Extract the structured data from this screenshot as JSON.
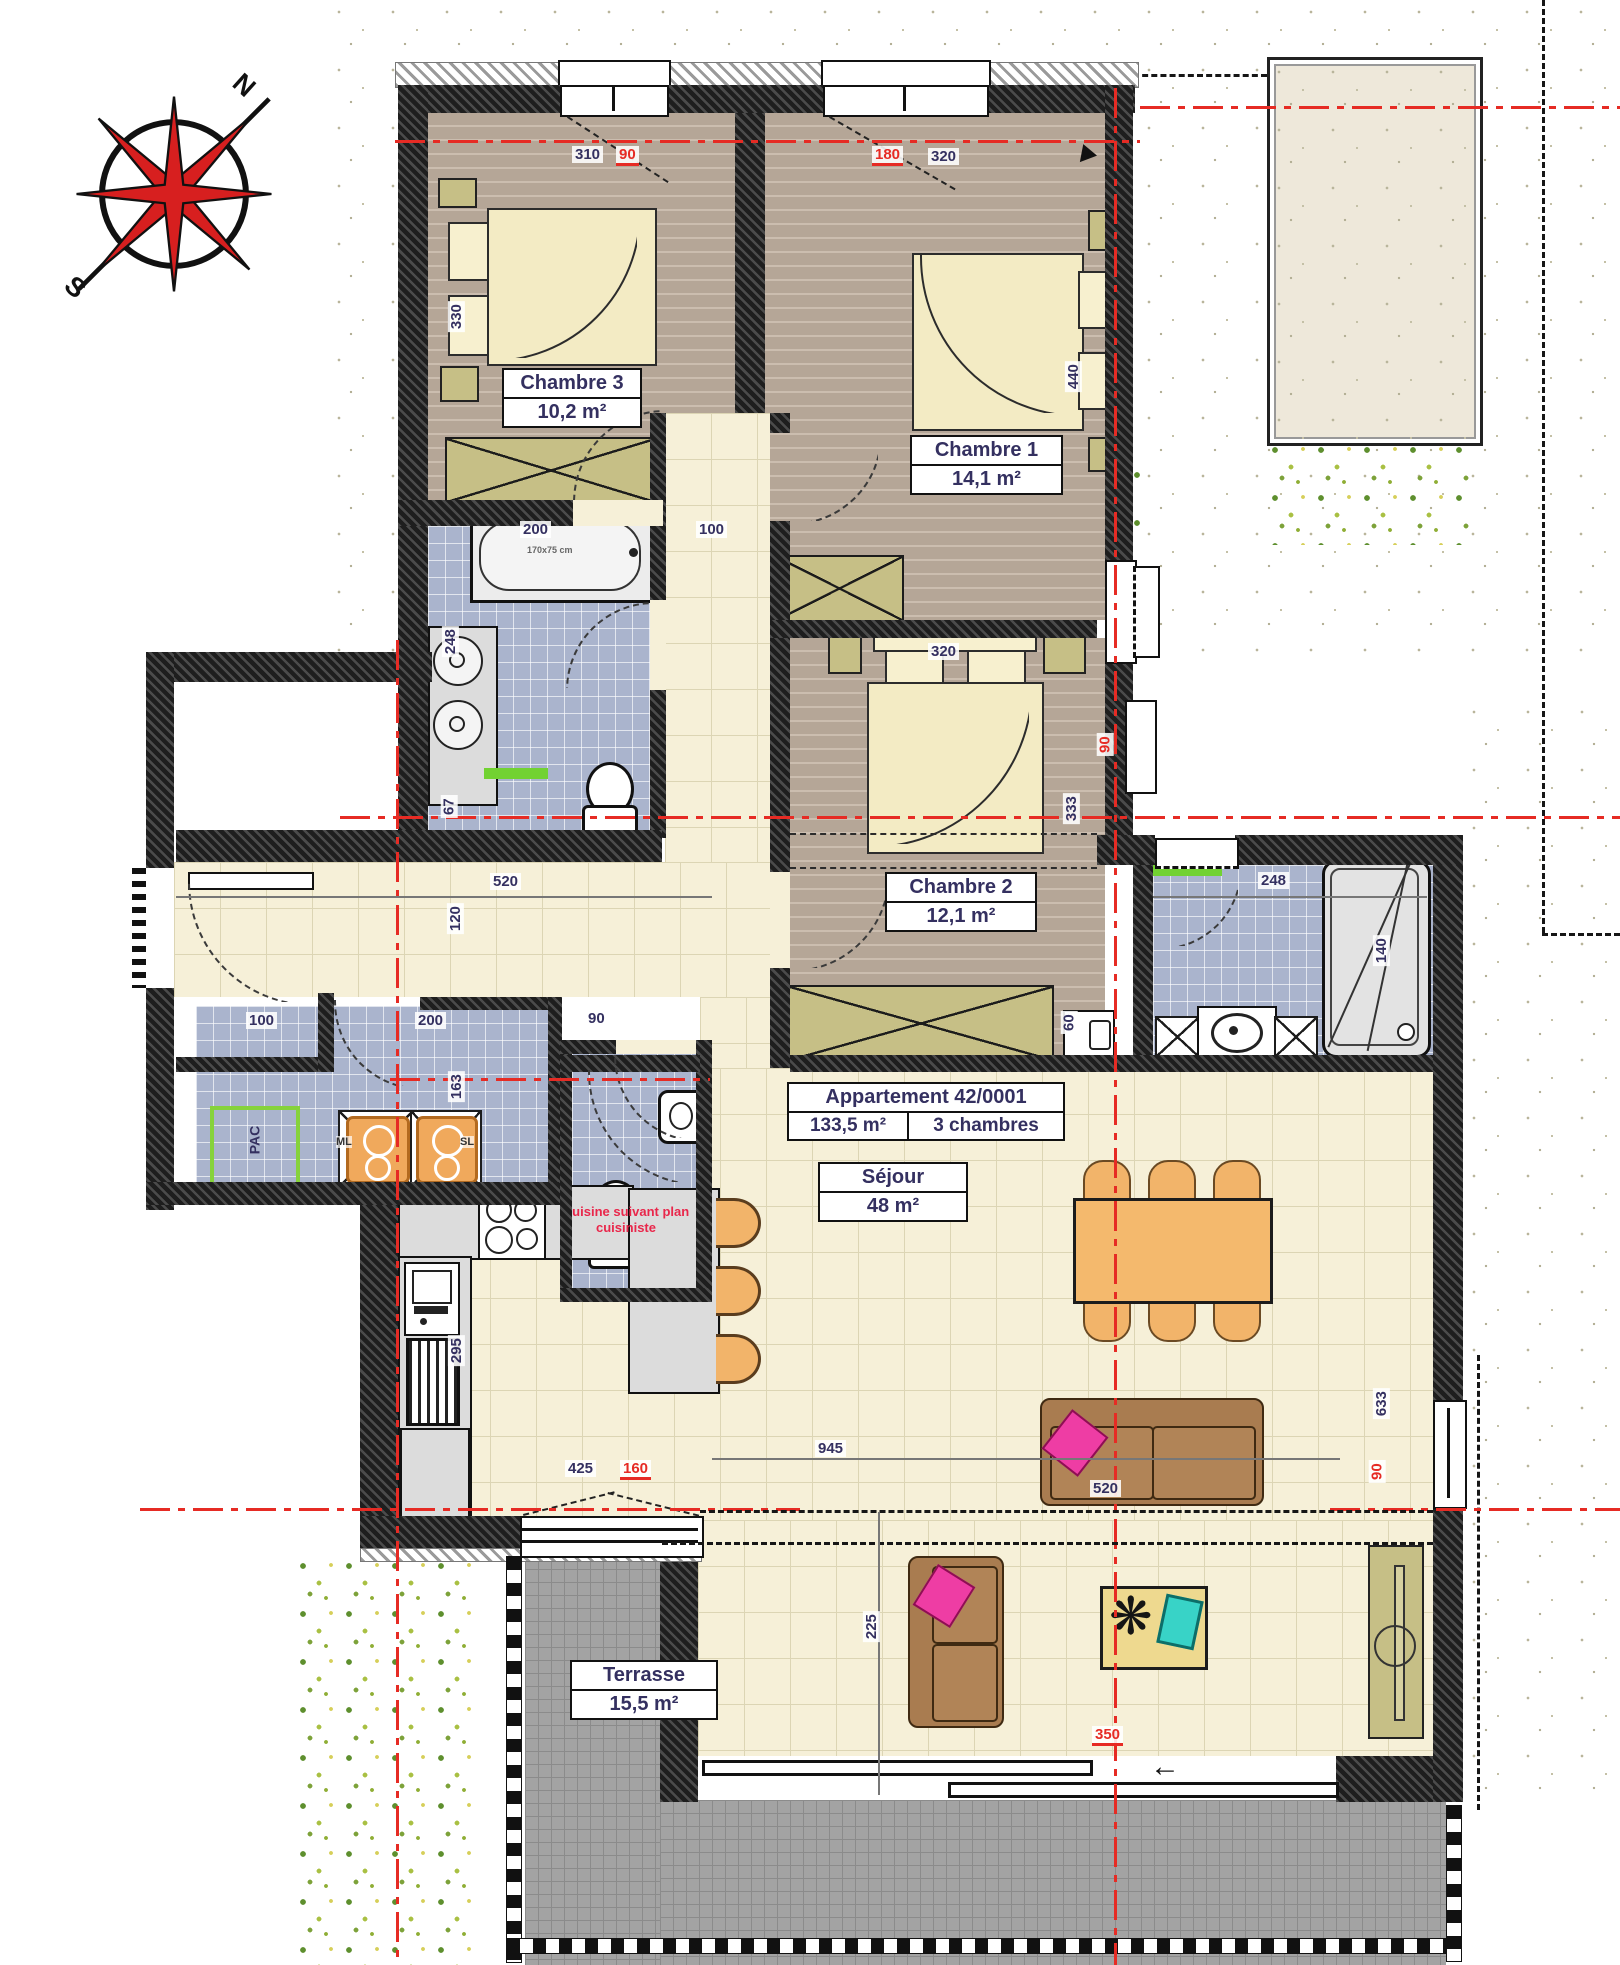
{
  "title_block": {
    "title": "Appartement 42/0001",
    "total_area": "133,5 m²",
    "rooms_count": "3 chambres"
  },
  "compass": {
    "north": "N",
    "south": "S"
  },
  "rooms": {
    "chambre3": {
      "name": "Chambre 3",
      "area": "10,2 m²"
    },
    "chambre1": {
      "name": "Chambre 1",
      "area": "14,1 m²"
    },
    "chambre2": {
      "name": "Chambre 2",
      "area": "12,1 m²"
    },
    "sejour": {
      "name": "Séjour",
      "area": "48 m²"
    },
    "terrasse": {
      "name": "Terrasse",
      "area": "15,5 m²"
    }
  },
  "annotations": {
    "kitchen_note_1": "Cuisine suivant plan",
    "kitchen_note_2": "cuisiniste",
    "pac": "PAC",
    "ml": "ML",
    "sl": "SL",
    "tub_size": "170x75 cm"
  },
  "dims": {
    "top_310": "310",
    "top_90": "90",
    "top_180": "180",
    "top_320": "320",
    "ch3_height": "330",
    "ch1_height": "440",
    "bath_width": "200",
    "corridor_width": "100",
    "bath_sink": "248",
    "bath_sink_depth": "67",
    "ch2_width": "320",
    "ch2_height": "333",
    "ch2_window": "90",
    "ch2_niche": "60",
    "hall_width": "520",
    "hall_depth": "120",
    "wardrobe_width": "100",
    "laundry_width": "200",
    "laundry_depth": "163",
    "wc_width": "90",
    "shower_room_width": "248",
    "shower_width": "140",
    "kitchen_depth": "295",
    "kitchen_window": "425",
    "kitchen_window_red": "160",
    "sejour_width": "945",
    "sofa_width": "520",
    "right_height": "633",
    "right_window": "90",
    "lower_depth": "225",
    "bay_width": "350"
  },
  "colors": {
    "axis_red": "#e62b24",
    "dimension_navy": "#343060",
    "note_red": "#e9274b",
    "accent_green": "#72d232",
    "pac_green": "#86d23c",
    "furniture_orange": "#f2b46a",
    "wall_black": "#1e1e1e",
    "floor_wood": "#b5a697",
    "tile_blue": "#aab4cd",
    "tile_cream": "#f6f0d8",
    "terrace_gray": "#a3a3a3",
    "highlight_pink": "#ee3da4",
    "highlight_cyan": "#38d3c7"
  }
}
